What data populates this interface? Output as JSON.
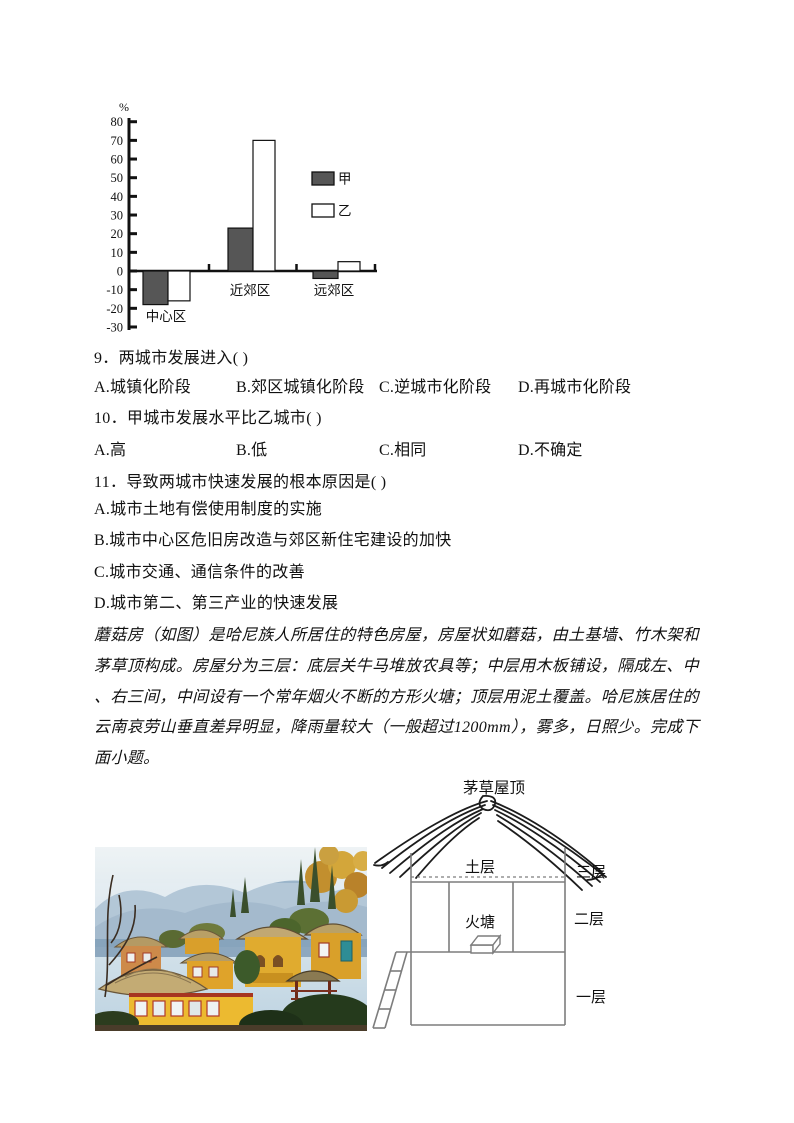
{
  "chart_data": {
    "type": "bar",
    "title": "",
    "ylabel": "%",
    "ylim": [
      -30,
      80
    ],
    "ytick_interval": 10,
    "grid": false,
    "legend_position": "right-inside",
    "categories": [
      "中心区",
      "近郊区",
      "远郊区"
    ],
    "series": [
      {
        "name": "甲",
        "fill": "#565656",
        "values": [
          -18,
          23,
          -4
        ]
      },
      {
        "name": "乙",
        "fill": "#ffffff",
        "values": [
          -16,
          70,
          5
        ]
      }
    ]
  },
  "questions": [
    {
      "number": "9．",
      "stem": "两城市发展进入( )",
      "options": [
        "A.城镇化阶段",
        "B.郊区城镇化阶段",
        "C.逆城市化阶段",
        "D.再城市化阶段"
      ]
    },
    {
      "number": "10．",
      "stem": "甲城市发展水平比乙城市( )",
      "options": [
        "A.高",
        "B.低",
        "C.相同",
        "D.不确定"
      ]
    },
    {
      "number": "11．",
      "stem": "导致两城市快速发展的根本原因是( )",
      "options": [
        "A.城市土地有偿使用制度的实施",
        "B.城市中心区危旧房改造与郊区新住宅建设的加快",
        "C.城市交通、通信条件的改善",
        "D.城市第二、第三产业的快速发展"
      ]
    }
  ],
  "passage": {
    "lines": [
      "蘑菇房（如图）是哈尼族人所居住的特色房屋，房屋状如蘑菇，由土基墙、竹木架和",
      "茅草顶构成。房屋分为三层：底层关牛马堆放农具等；中层用木板铺设，隔成左、中",
      "、右三间，中间设有一个常年烟火不断的方形火塘；顶层用泥土覆盖。哈尼族居住的",
      "云南哀劳山垂直差异明显，降雨量较大（一般超过1200mm），雾多，日照少。完成下",
      "面小题。"
    ]
  },
  "diagram": {
    "roof_label": "茅草屋顶",
    "soil_label": "土层",
    "floor3_label": "三层",
    "firepit_label": "火塘",
    "floor2_label": "二层",
    "floor1_label": "一层"
  }
}
